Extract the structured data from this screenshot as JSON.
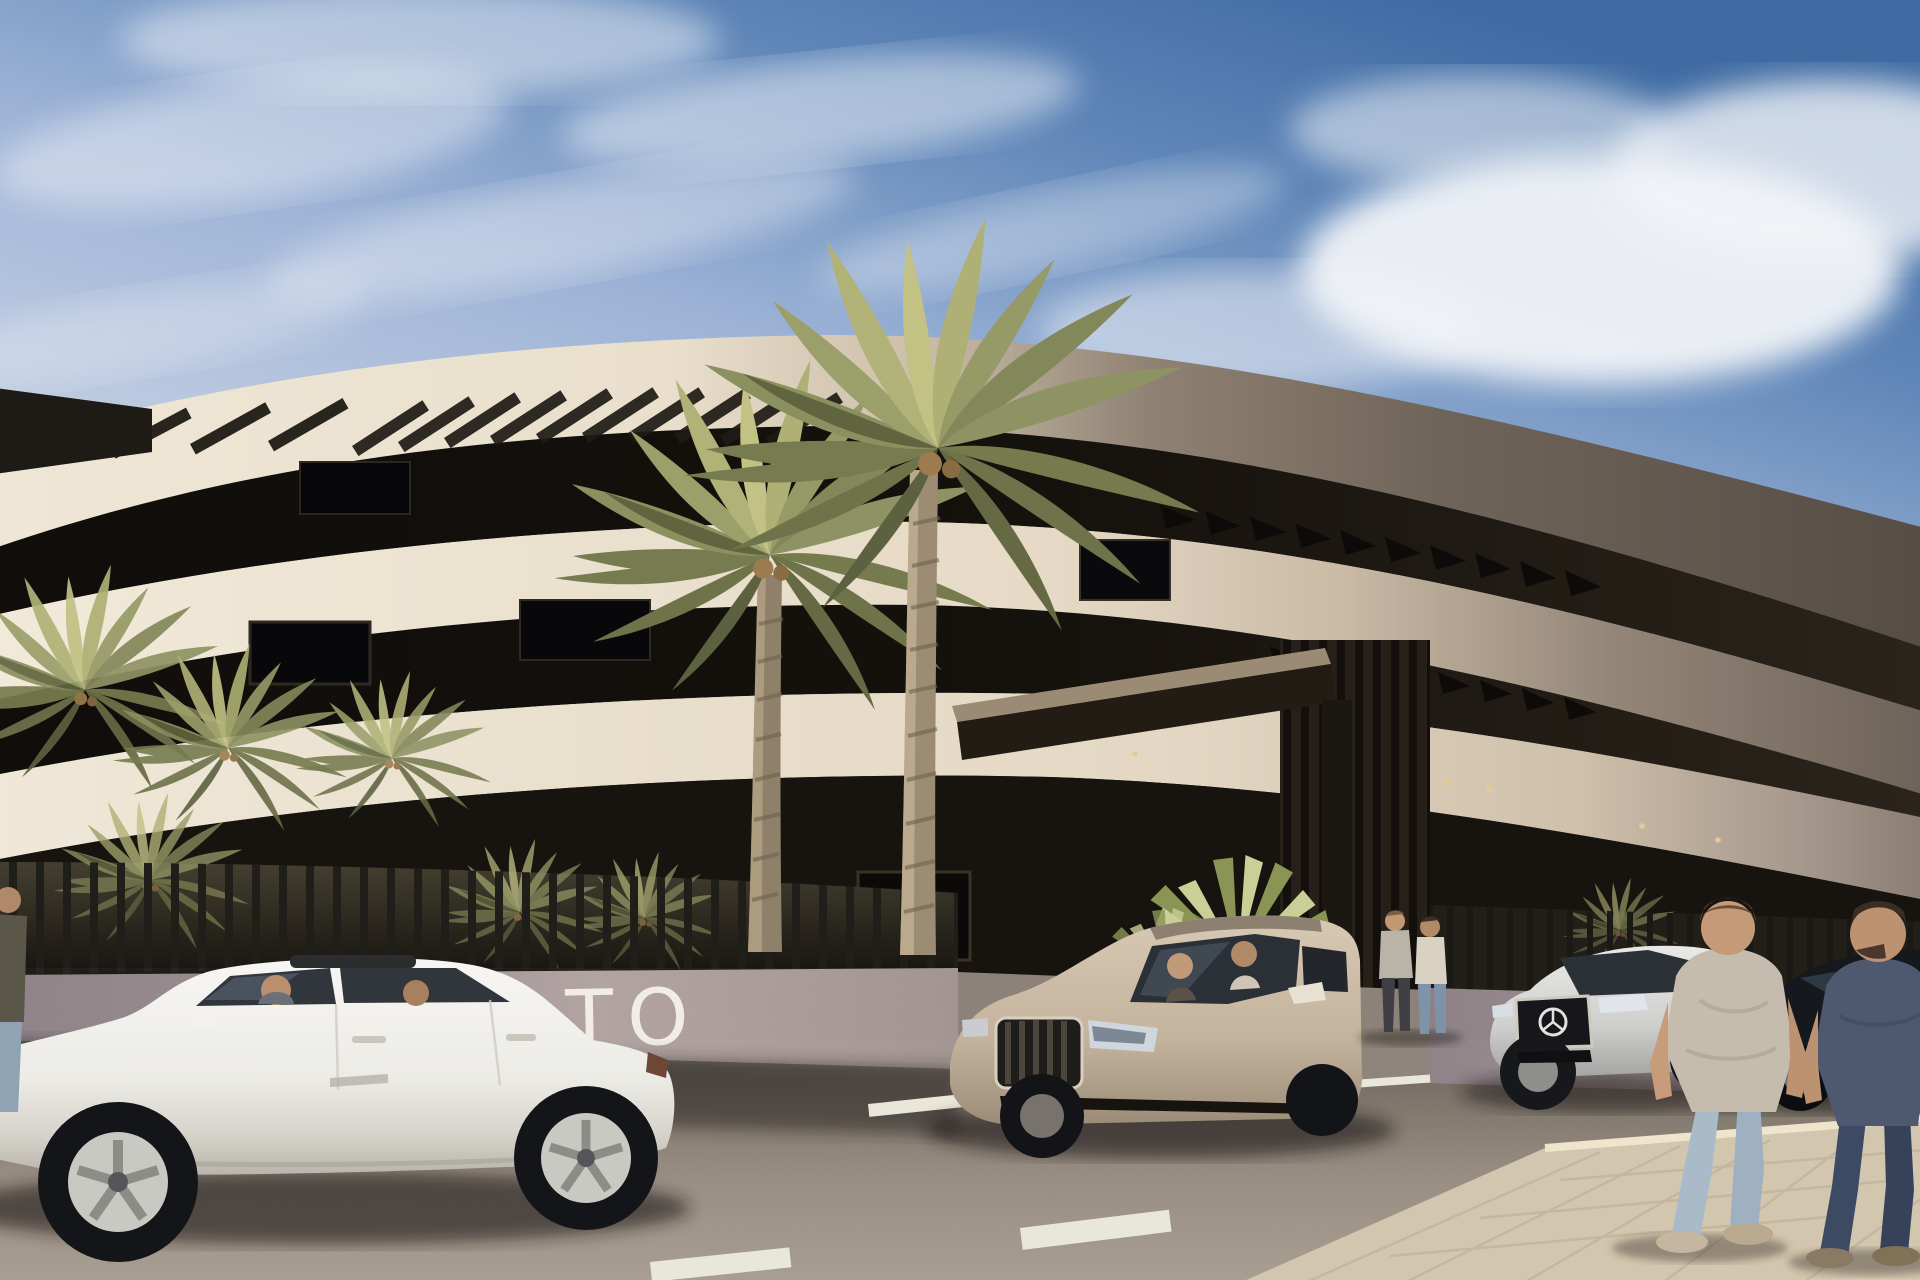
{
  "scene": {
    "type": "architectural-exterior-render",
    "time_of_day": "sunny afternoon",
    "wall_sign_text": "TO",
    "description": "Street-level render of a modern curved white apartment building with roof pergola slats, palm trees, a slatted privacy fence over a mauve wall, four parked cars and pedestrians"
  },
  "building": {
    "style": "contemporary curved balconies, three visible fascia bands",
    "features": [
      "roof pergola slats",
      "dark recessed glazing between bands",
      "entrance canopy",
      "vertical louvre screen",
      "warm downlights"
    ],
    "lighting": "sunlit cream on left, shadowed grey-brown toward right"
  },
  "vehicles": [
    {
      "name": "white-sedan",
      "view": "side, facing left",
      "occupants": 2
    },
    {
      "name": "champagne-suv",
      "view": "front three-quarter, facing left",
      "occupants": 2
    },
    {
      "name": "silver-sedan-mercedes",
      "view": "front three-quarter",
      "occupants": 0
    },
    {
      "name": "dark-sedan",
      "view": "partially hidden at right edge",
      "occupants": 0
    }
  ],
  "people": [
    {
      "name": "pedestrian-beige-shirt",
      "pose": "walking away on sidewalk, light jeans"
    },
    {
      "name": "pedestrian-dark-shirt",
      "pose": "walking away on sidewalk, dark jeans"
    },
    {
      "name": "standing-pair-at-entrance",
      "pose": "two small figures talking near entrance"
    },
    {
      "name": "partial-figure-left-edge",
      "pose": "cropped by frame"
    }
  ],
  "vegetation": [
    "two tall date palms at center",
    "small palm crowns at left behind fence",
    "spiky yucca bush at entrance"
  ],
  "road": {
    "surface": "speckled grey asphalt",
    "markings": "short white lane dashes",
    "sidewalk": "light tan pavers bottom right"
  },
  "palette": {
    "sky_deep": "#3f6ba3",
    "sky_light": "#c3cfe3",
    "cloud": "#f2f4f8",
    "fascia_sunlit": "#efe6d6",
    "fascia_shadow": "#5a5047",
    "recess_dark": "#14110d",
    "wall": "#9b8d90",
    "road": "#968b7f",
    "sidewalk": "#d3c6ae",
    "palm_green": "#8e9363",
    "white_car": "#f3f2ee",
    "suv": "#c9b8a2",
    "silver_car": "#d9d9d7",
    "dark_car": "#15181d",
    "downlight": "#e9c894"
  }
}
